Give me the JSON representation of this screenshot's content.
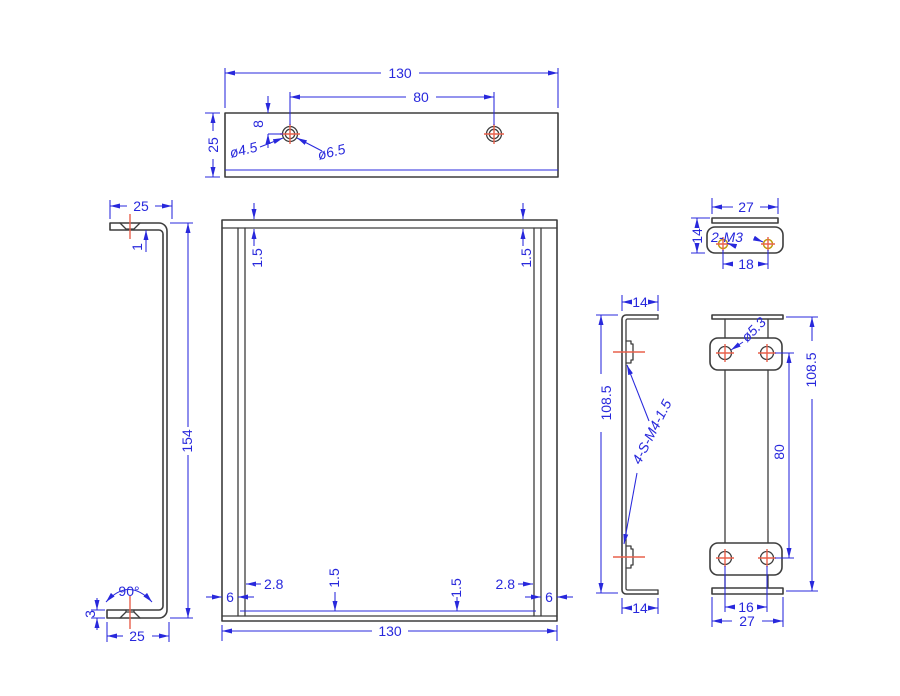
{
  "drawing_title": "sheet-metal bracket multi-view engineering drawing",
  "colors": {
    "background": "#ffffff",
    "geometry": "#3d3d3d",
    "dimension": "#2828dc",
    "center_mark": "#e8604c",
    "tapped_hole": "#c09c10"
  },
  "views": {
    "top": {
      "width": "130",
      "hole_spacing": "80",
      "depth": "25",
      "edge_offset": "8",
      "hole_small": "ø4.5",
      "hole_large": "ø6.5"
    },
    "left": {
      "flange_width": "25",
      "step": "1",
      "height": "154",
      "bend_angle": "90°",
      "thickness": "3",
      "flange_width_bottom": "25"
    },
    "front": {
      "thickness_top_left": "1.5",
      "thickness_top_right": "1.5",
      "inset_left": "2.8",
      "lip_left": "6",
      "thickness_bottom_left": "1.5",
      "thickness_bottom_right": "1.5",
      "inset_right": "2.8",
      "lip_right": "6",
      "width": "130"
    },
    "channel": {
      "flange_top": "14",
      "height": "108.5",
      "nut_callout": "4-S-M4-1.5",
      "flange_bottom": "14"
    },
    "strip": {
      "hole_dia": "ø5.3",
      "height": "108.5",
      "hole_spacing": "80",
      "hole_pitch": "16",
      "width": "27"
    },
    "clip": {
      "width": "27",
      "height": "14",
      "thread_callout": "2-M3",
      "hole_spacing": "18"
    }
  }
}
